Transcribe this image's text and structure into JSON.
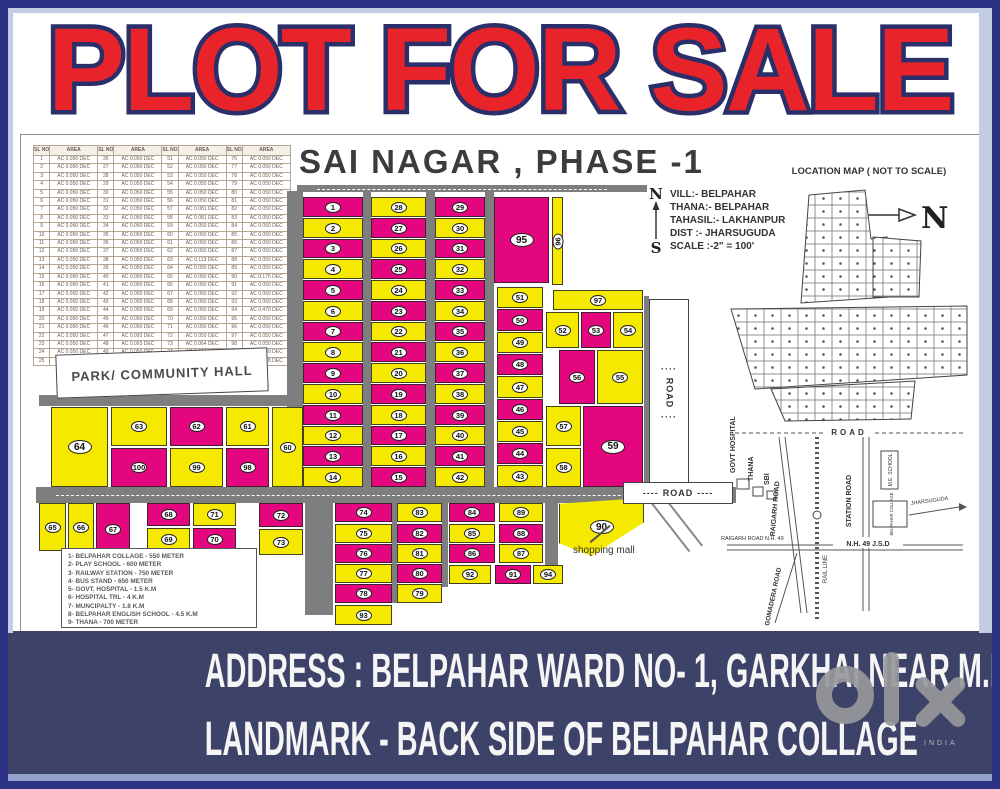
{
  "poster": {
    "title": "PLOT FOR SALE"
  },
  "map": {
    "title": "SAI NAGAR , PHASE -1",
    "table": {
      "header_sl": "SL NO",
      "header_area": "AREA",
      "rows": [
        [
          "1",
          "AC 0.050 DEC",
          "26",
          "AC 0.050 DEC",
          "51",
          "AC 0.050 DEC",
          "76",
          "AC 0.050 DEC"
        ],
        [
          "2",
          "AC 0.050 DEC",
          "27",
          "AC 0.050 DEC",
          "52",
          "AC 0.050 DEC",
          "77",
          "AC 0.050 DEC"
        ],
        [
          "3",
          "AC 0.050 DEC",
          "28",
          "AC 0.050 DEC",
          "53",
          "AC 0.050 DEC",
          "78",
          "AC 0.050 DEC"
        ],
        [
          "4",
          "AC 0.050 DEC",
          "29",
          "AC 0.050 DEC",
          "54",
          "AC 0.050 DEC",
          "79",
          "AC 0.050 DEC"
        ],
        [
          "5",
          "AC 0.050 DEC",
          "30",
          "AC 0.050 DEC",
          "55",
          "AC 0.050 DEC",
          "80",
          "AC 0.050 DEC"
        ],
        [
          "6",
          "AC 0.050 DEC",
          "31",
          "AC 0.050 DEC",
          "56",
          "AC 0.050 DEC",
          "81",
          "AC 0.050 DEC"
        ],
        [
          "7",
          "AC 0.050 DEC",
          "32",
          "AC 0.050 DEC",
          "57",
          "AC 0.081 DEC",
          "82",
          "AC 0.050 DEC"
        ],
        [
          "8",
          "AC 0.050 DEC",
          "33",
          "AC 0.050 DEC",
          "58",
          "AC 0.081 DEC",
          "83",
          "AC 0.050 DEC"
        ],
        [
          "9",
          "AC 0.050 DEC",
          "34",
          "AC 0.050 DEC",
          "59",
          "AC 0.050 DEC",
          "84",
          "AC 0.050 DEC"
        ],
        [
          "10",
          "AC 0.050 DEC",
          "35",
          "AC 0.050 DEC",
          "60",
          "AC 0.050 DEC",
          "85",
          "AC 0.050 DEC"
        ],
        [
          "11",
          "AC 0.050 DEC",
          "36",
          "AC 0.050 DEC",
          "61",
          "AC 0.050 DEC",
          "86",
          "AC 0.050 DEC"
        ],
        [
          "12",
          "AC 0.050 DEC",
          "37",
          "AC 0.050 DEC",
          "62",
          "AC 0.050 DEC",
          "87",
          "AC 0.050 DEC"
        ],
        [
          "13",
          "AC 0.050 DEC",
          "38",
          "AC 0.050 DEC",
          "63",
          "AC 0.113 DEC",
          "88",
          "AC 0.050 DEC"
        ],
        [
          "14",
          "AC 0.050 DEC",
          "39",
          "AC 0.050 DEC",
          "64",
          "AC 0.050 DEC",
          "89",
          "AC 0.050 DEC"
        ],
        [
          "15",
          "AC 0.050 DEC",
          "40",
          "AC 0.050 DEC",
          "65",
          "AC 0.050 DEC",
          "90",
          "AC 0.175 DEC"
        ],
        [
          "16",
          "AC 0.050 DEC",
          "41",
          "AC 0.050 DEC",
          "66",
          "AC 0.050 DEC",
          "91",
          "AC 0.050 DEC"
        ],
        [
          "17",
          "AC 0.050 DEC",
          "42",
          "AC 0.050 DEC",
          "67",
          "AC 0.050 DEC",
          "92",
          "AC 0.050 DEC"
        ],
        [
          "18",
          "AC 0.050 DEC",
          "43",
          "AC 0.050 DEC",
          "68",
          "AC 0.050 DEC",
          "93",
          "AC 0.050 DEC"
        ],
        [
          "19",
          "AC 0.050 DEC",
          "44",
          "AC 0.050 DEC",
          "69",
          "AC 0.050 DEC",
          "94",
          "AC 0.470 DEC"
        ],
        [
          "20",
          "AC 0.050 DEC",
          "45",
          "AC 0.050 DEC",
          "70",
          "AC 0.050 DEC",
          "95",
          "AC 0.050 DEC"
        ],
        [
          "21",
          "AC 0.050 DEC",
          "46",
          "AC 0.050 DEC",
          "71",
          "AC 0.050 DEC",
          "96",
          "AC 0.050 DEC"
        ],
        [
          "22",
          "AC 0.050 DEC",
          "47",
          "AC 0.093 DEC",
          "72",
          "AC 0.050 DEC",
          "97",
          "AC 0.050 DEC"
        ],
        [
          "23",
          "AC 0.050 DEC",
          "48",
          "AC 0.093 DEC",
          "73",
          "AC 0.064 DEC",
          "98",
          "AC 0.050 DEC"
        ],
        [
          "24",
          "AC 0.050 DEC",
          "49",
          "AC 0.050 DEC",
          "74",
          "AC 0.064 DEC",
          "99",
          "AC 0.050 DEC"
        ],
        [
          "25",
          "AC 0.050 DEC",
          "50",
          "AC 0.050 DEC",
          "75",
          "AC 0.050 DEC",
          "100",
          "AC 0.278 DEC"
        ]
      ]
    },
    "compass": {
      "north": "N",
      "south": "S"
    },
    "site_info": [
      "VILL:- BELPAHAR",
      "THANA:- BELPAHAR",
      "TAHASIL:- LAKHANPUR",
      "DIST   :- JHARSUGUDA",
      "SCALE :-2\" = 100'"
    ],
    "park_label": "PARK/ COMMUNITY HALL",
    "legend": [
      "1- BELPAHAR COLLAGE - 550 METER",
      "2- PLAY SCHOOL - 600  METER",
      "3- RAILWAY STATION - 750 METER",
      "4- BUS STAND - 650 METER",
      "5- GOVT. HOSPITAL - 1.5 K.M",
      "6- HOSPITAL TRL - 4 K.M",
      "7- MUNCIPALTY - 1.8 K.M",
      "8- BELPAHAR ENGLISH SCHOOL - 4.5 K.M",
      "9- THANA - 700 METER"
    ],
    "shopping_mall": "shopping mall",
    "road_label_v": "ROAD",
    "road_label_h": "ROAD",
    "vdash": "····",
    "hdash": "----",
    "colors": {
      "magenta": "#E4067E",
      "yellow": "#F6E900",
      "road": "#7E7E7E"
    },
    "plots": [
      {
        "n": "1",
        "x": 282,
        "y": 62,
        "w": 60,
        "h": 20,
        "c": "m"
      },
      {
        "n": "2",
        "x": 282,
        "y": 83,
        "w": 60,
        "h": 20,
        "c": "y"
      },
      {
        "n": "3",
        "x": 282,
        "y": 104,
        "w": 60,
        "h": 19,
        "c": "m"
      },
      {
        "n": "4",
        "x": 282,
        "y": 124,
        "w": 60,
        "h": 20,
        "c": "y"
      },
      {
        "n": "5",
        "x": 282,
        "y": 145,
        "w": 60,
        "h": 20,
        "c": "m"
      },
      {
        "n": "6",
        "x": 282,
        "y": 166,
        "w": 60,
        "h": 20,
        "c": "y"
      },
      {
        "n": "7",
        "x": 282,
        "y": 187,
        "w": 60,
        "h": 19,
        "c": "m"
      },
      {
        "n": "8",
        "x": 282,
        "y": 207,
        "w": 60,
        "h": 20,
        "c": "y"
      },
      {
        "n": "9",
        "x": 282,
        "y": 228,
        "w": 60,
        "h": 20,
        "c": "m"
      },
      {
        "n": "10",
        "x": 282,
        "y": 249,
        "w": 60,
        "h": 20,
        "c": "y"
      },
      {
        "n": "11",
        "x": 282,
        "y": 270,
        "w": 60,
        "h": 20,
        "c": "m"
      },
      {
        "n": "12",
        "x": 282,
        "y": 291,
        "w": 60,
        "h": 19,
        "c": "y"
      },
      {
        "n": "13",
        "x": 282,
        "y": 311,
        "w": 60,
        "h": 20,
        "c": "m"
      },
      {
        "n": "14",
        "x": 282,
        "y": 332,
        "w": 60,
        "h": 20,
        "c": "y"
      },
      {
        "n": "28",
        "x": 350,
        "y": 62,
        "w": 55,
        "h": 20,
        "c": "y"
      },
      {
        "n": "27",
        "x": 350,
        "y": 83,
        "w": 55,
        "h": 20,
        "c": "m"
      },
      {
        "n": "26",
        "x": 350,
        "y": 104,
        "w": 55,
        "h": 19,
        "c": "y"
      },
      {
        "n": "25",
        "x": 350,
        "y": 124,
        "w": 55,
        "h": 20,
        "c": "m"
      },
      {
        "n": "24",
        "x": 350,
        "y": 145,
        "w": 55,
        "h": 20,
        "c": "y"
      },
      {
        "n": "23",
        "x": 350,
        "y": 166,
        "w": 55,
        "h": 20,
        "c": "m"
      },
      {
        "n": "22",
        "x": 350,
        "y": 187,
        "w": 55,
        "h": 19,
        "c": "y"
      },
      {
        "n": "21",
        "x": 350,
        "y": 207,
        "w": 55,
        "h": 20,
        "c": "m"
      },
      {
        "n": "20",
        "x": 350,
        "y": 228,
        "w": 55,
        "h": 20,
        "c": "y"
      },
      {
        "n": "19",
        "x": 350,
        "y": 249,
        "w": 55,
        "h": 20,
        "c": "m"
      },
      {
        "n": "18",
        "x": 350,
        "y": 270,
        "w": 55,
        "h": 20,
        "c": "y"
      },
      {
        "n": "17",
        "x": 350,
        "y": 291,
        "w": 55,
        "h": 19,
        "c": "m"
      },
      {
        "n": "16",
        "x": 350,
        "y": 311,
        "w": 55,
        "h": 20,
        "c": "y"
      },
      {
        "n": "15",
        "x": 350,
        "y": 332,
        "w": 55,
        "h": 20,
        "c": "m"
      },
      {
        "n": "29",
        "x": 414,
        "y": 62,
        "w": 50,
        "h": 20,
        "c": "m"
      },
      {
        "n": "30",
        "x": 414,
        "y": 83,
        "w": 50,
        "h": 20,
        "c": "y"
      },
      {
        "n": "31",
        "x": 414,
        "y": 104,
        "w": 50,
        "h": 19,
        "c": "m"
      },
      {
        "n": "32",
        "x": 414,
        "y": 124,
        "w": 50,
        "h": 20,
        "c": "y"
      },
      {
        "n": "33",
        "x": 414,
        "y": 145,
        "w": 50,
        "h": 20,
        "c": "m"
      },
      {
        "n": "34",
        "x": 414,
        "y": 166,
        "w": 50,
        "h": 20,
        "c": "y"
      },
      {
        "n": "35",
        "x": 414,
        "y": 187,
        "w": 50,
        "h": 19,
        "c": "m"
      },
      {
        "n": "36",
        "x": 414,
        "y": 207,
        "w": 50,
        "h": 20,
        "c": "y"
      },
      {
        "n": "37",
        "x": 414,
        "y": 228,
        "w": 50,
        "h": 20,
        "c": "m"
      },
      {
        "n": "38",
        "x": 414,
        "y": 249,
        "w": 50,
        "h": 20,
        "c": "y"
      },
      {
        "n": "39",
        "x": 414,
        "y": 270,
        "w": 50,
        "h": 20,
        "c": "m"
      },
      {
        "n": "40",
        "x": 414,
        "y": 291,
        "w": 50,
        "h": 19,
        "c": "y"
      },
      {
        "n": "41",
        "x": 414,
        "y": 311,
        "w": 50,
        "h": 20,
        "c": "m"
      },
      {
        "n": "42",
        "x": 414,
        "y": 332,
        "w": 50,
        "h": 20,
        "c": "y"
      },
      {
        "n": "95",
        "x": 473,
        "y": 62,
        "w": 55,
        "h": 86,
        "c": "m"
      },
      {
        "n": "96",
        "x": 531,
        "y": 62,
        "w": 11,
        "h": 88,
        "c": "y"
      },
      {
        "n": "51",
        "x": 476,
        "y": 152,
        "w": 46,
        "h": 21,
        "c": "y"
      },
      {
        "n": "50",
        "x": 476,
        "y": 174,
        "w": 46,
        "h": 22,
        "c": "m"
      },
      {
        "n": "49",
        "x": 476,
        "y": 197,
        "w": 46,
        "h": 21,
        "c": "y"
      },
      {
        "n": "48",
        "x": 476,
        "y": 219,
        "w": 46,
        "h": 21,
        "c": "m"
      },
      {
        "n": "47",
        "x": 476,
        "y": 241,
        "w": 46,
        "h": 22,
        "c": "y"
      },
      {
        "n": "46",
        "x": 476,
        "y": 264,
        "w": 46,
        "h": 21,
        "c": "m"
      },
      {
        "n": "45",
        "x": 476,
        "y": 286,
        "w": 46,
        "h": 21,
        "c": "y"
      },
      {
        "n": "44",
        "x": 476,
        "y": 308,
        "w": 46,
        "h": 21,
        "c": "m"
      },
      {
        "n": "43",
        "x": 476,
        "y": 330,
        "w": 46,
        "h": 22,
        "c": "y"
      },
      {
        "n": "97",
        "x": 532,
        "y": 155,
        "w": 90,
        "h": 20,
        "c": "y"
      },
      {
        "n": "52",
        "x": 525,
        "y": 177,
        "w": 33,
        "h": 36,
        "c": "y"
      },
      {
        "n": "53",
        "x": 560,
        "y": 177,
        "w": 30,
        "h": 36,
        "c": "m"
      },
      {
        "n": "54",
        "x": 592,
        "y": 177,
        "w": 30,
        "h": 36,
        "c": "y"
      },
      {
        "n": "56",
        "x": 538,
        "y": 215,
        "w": 36,
        "h": 54,
        "c": "m"
      },
      {
        "n": "55",
        "x": 576,
        "y": 215,
        "w": 46,
        "h": 54,
        "c": "y"
      },
      {
        "n": "57",
        "x": 525,
        "y": 271,
        "w": 35,
        "h": 40,
        "c": "y"
      },
      {
        "n": "58",
        "x": 525,
        "y": 313,
        "w": 35,
        "h": 39,
        "c": "y"
      },
      {
        "n": "59",
        "x": 562,
        "y": 271,
        "w": 60,
        "h": 81,
        "c": "m"
      },
      {
        "n": "64",
        "x": 30,
        "y": 272,
        "w": 57,
        "h": 80,
        "c": "y"
      },
      {
        "n": "63",
        "x": 90,
        "y": 272,
        "w": 56,
        "h": 39,
        "c": "y"
      },
      {
        "n": "100",
        "x": 90,
        "y": 313,
        "w": 56,
        "h": 39,
        "c": "m"
      },
      {
        "n": "62",
        "x": 149,
        "y": 272,
        "w": 53,
        "h": 39,
        "c": "m"
      },
      {
        "n": "99",
        "x": 149,
        "y": 313,
        "w": 53,
        "h": 39,
        "c": "y"
      },
      {
        "n": "61",
        "x": 205,
        "y": 272,
        "w": 43,
        "h": 39,
        "c": "y"
      },
      {
        "n": "98",
        "x": 205,
        "y": 313,
        "w": 43,
        "h": 39,
        "c": "m"
      },
      {
        "n": "60",
        "x": 251,
        "y": 272,
        "w": 31,
        "h": 80,
        "c": "y"
      },
      {
        "n": "65",
        "x": 18,
        "y": 368,
        "w": 27,
        "h": 48,
        "c": "y"
      },
      {
        "n": "66",
        "x": 47,
        "y": 368,
        "w": 26,
        "h": 48,
        "c": "y"
      },
      {
        "n": "67",
        "x": 75,
        "y": 368,
        "w": 34,
        "h": 52,
        "c": "m"
      },
      {
        "n": "68",
        "x": 126,
        "y": 368,
        "w": 43,
        "h": 23,
        "c": "m"
      },
      {
        "n": "69",
        "x": 126,
        "y": 393,
        "w": 43,
        "h": 23,
        "c": "y"
      },
      {
        "n": "71",
        "x": 172,
        "y": 368,
        "w": 43,
        "h": 23,
        "c": "y"
      },
      {
        "n": "70",
        "x": 172,
        "y": 393,
        "w": 43,
        "h": 23,
        "c": "m"
      },
      {
        "n": "72",
        "x": 238,
        "y": 368,
        "w": 44,
        "h": 24,
        "c": "m"
      },
      {
        "n": "73",
        "x": 238,
        "y": 394,
        "w": 44,
        "h": 26,
        "c": "y"
      },
      {
        "n": "74",
        "x": 314,
        "y": 368,
        "w": 57,
        "h": 19,
        "c": "m"
      },
      {
        "n": "75",
        "x": 314,
        "y": 389,
        "w": 57,
        "h": 19,
        "c": "y"
      },
      {
        "n": "76",
        "x": 314,
        "y": 409,
        "w": 57,
        "h": 19,
        "c": "m"
      },
      {
        "n": "77",
        "x": 314,
        "y": 429,
        "w": 57,
        "h": 19,
        "c": "y"
      },
      {
        "n": "78",
        "x": 314,
        "y": 449,
        "w": 57,
        "h": 19,
        "c": "m"
      },
      {
        "n": "93",
        "x": 314,
        "y": 470,
        "w": 57,
        "h": 20,
        "c": "y"
      },
      {
        "n": "83",
        "x": 376,
        "y": 368,
        "w": 45,
        "h": 19,
        "c": "y"
      },
      {
        "n": "82",
        "x": 376,
        "y": 389,
        "w": 45,
        "h": 19,
        "c": "m"
      },
      {
        "n": "81",
        "x": 376,
        "y": 409,
        "w": 45,
        "h": 19,
        "c": "y"
      },
      {
        "n": "80",
        "x": 376,
        "y": 429,
        "w": 45,
        "h": 19,
        "c": "m"
      },
      {
        "n": "79",
        "x": 376,
        "y": 449,
        "w": 45,
        "h": 19,
        "c": "y"
      },
      {
        "n": "84",
        "x": 428,
        "y": 368,
        "w": 46,
        "h": 19,
        "c": "m"
      },
      {
        "n": "85",
        "x": 428,
        "y": 389,
        "w": 46,
        "h": 19,
        "c": "y"
      },
      {
        "n": "86",
        "x": 428,
        "y": 409,
        "w": 46,
        "h": 19,
        "c": "m"
      },
      {
        "n": "92",
        "x": 428,
        "y": 430,
        "w": 42,
        "h": 19,
        "c": "y"
      },
      {
        "n": "89",
        "x": 478,
        "y": 368,
        "w": 44,
        "h": 19,
        "c": "y"
      },
      {
        "n": "88",
        "x": 478,
        "y": 389,
        "w": 44,
        "h": 19,
        "c": "m"
      },
      {
        "n": "87",
        "x": 478,
        "y": 409,
        "w": 44,
        "h": 19,
        "c": "y"
      },
      {
        "n": "91",
        "x": 474,
        "y": 430,
        "w": 36,
        "h": 19,
        "c": "m"
      },
      {
        "n": "94",
        "x": 512,
        "y": 430,
        "w": 30,
        "h": 19,
        "c": "y"
      },
      {
        "n": "90",
        "x": 538,
        "y": 363,
        "w": 85,
        "h": 58,
        "c": "y",
        "clip": "polygon(0% 10%, 100% 0%, 100% 42%, 38% 100%, 0% 78%)"
      }
    ],
    "roads": [
      {
        "x": 266,
        "y": 56,
        "w": 16,
        "h": 312
      },
      {
        "x": 342,
        "y": 56,
        "w": 8,
        "h": 312
      },
      {
        "x": 405,
        "y": 56,
        "w": 9,
        "h": 312
      },
      {
        "x": 464,
        "y": 56,
        "w": 9,
        "h": 312
      },
      {
        "x": 276,
        "y": 50,
        "w": 350,
        "h": 7
      },
      {
        "x": 15,
        "y": 352,
        "w": 700,
        "h": 16
      },
      {
        "x": 18,
        "y": 260,
        "w": 264,
        "h": 11
      },
      {
        "x": 284,
        "y": 368,
        "w": 28,
        "h": 112
      },
      {
        "x": 371,
        "y": 368,
        "w": 5,
        "h": 100
      },
      {
        "x": 421,
        "y": 368,
        "w": 6,
        "h": 84
      },
      {
        "x": 524,
        "y": 363,
        "w": 13,
        "h": 76
      },
      {
        "x": 623,
        "y": 161,
        "w": 5,
        "h": 191
      }
    ]
  },
  "location_map": {
    "title": "LOCATION MAP ( NOT TO SCALE)",
    "north": "N",
    "labels": {
      "road_top": "ROAD",
      "govt_hospital": "GOVT HOSPITAL",
      "thana": "THANA",
      "sbi": "SBI",
      "raigarh_road": "RAIGARH ROAD",
      "station_road": "STATION ROAD",
      "me_school": "M.E. SCHOOL",
      "belpahar_collage": "BELPAHAR COLLAGE",
      "jharsuguda": "JHARSUGUDA",
      "nh49": "N.H. 49 J.S.D",
      "raigarh_nh49": "RAIGARH ROAD N.H. 49",
      "gomadera_road": "GOMADERA ROAD",
      "rail_line": "RAIL LINE"
    }
  },
  "footer": {
    "line1": "ADDRESS : BELPAHAR WARD NO- 1, GARKHAI NEAR M.E. SCHOOL",
    "line2": "LANDMARK - BACK SIDE OF BELPAHAR COLLAGE",
    "brand": "olx",
    "brand_sub": "INDIA"
  }
}
